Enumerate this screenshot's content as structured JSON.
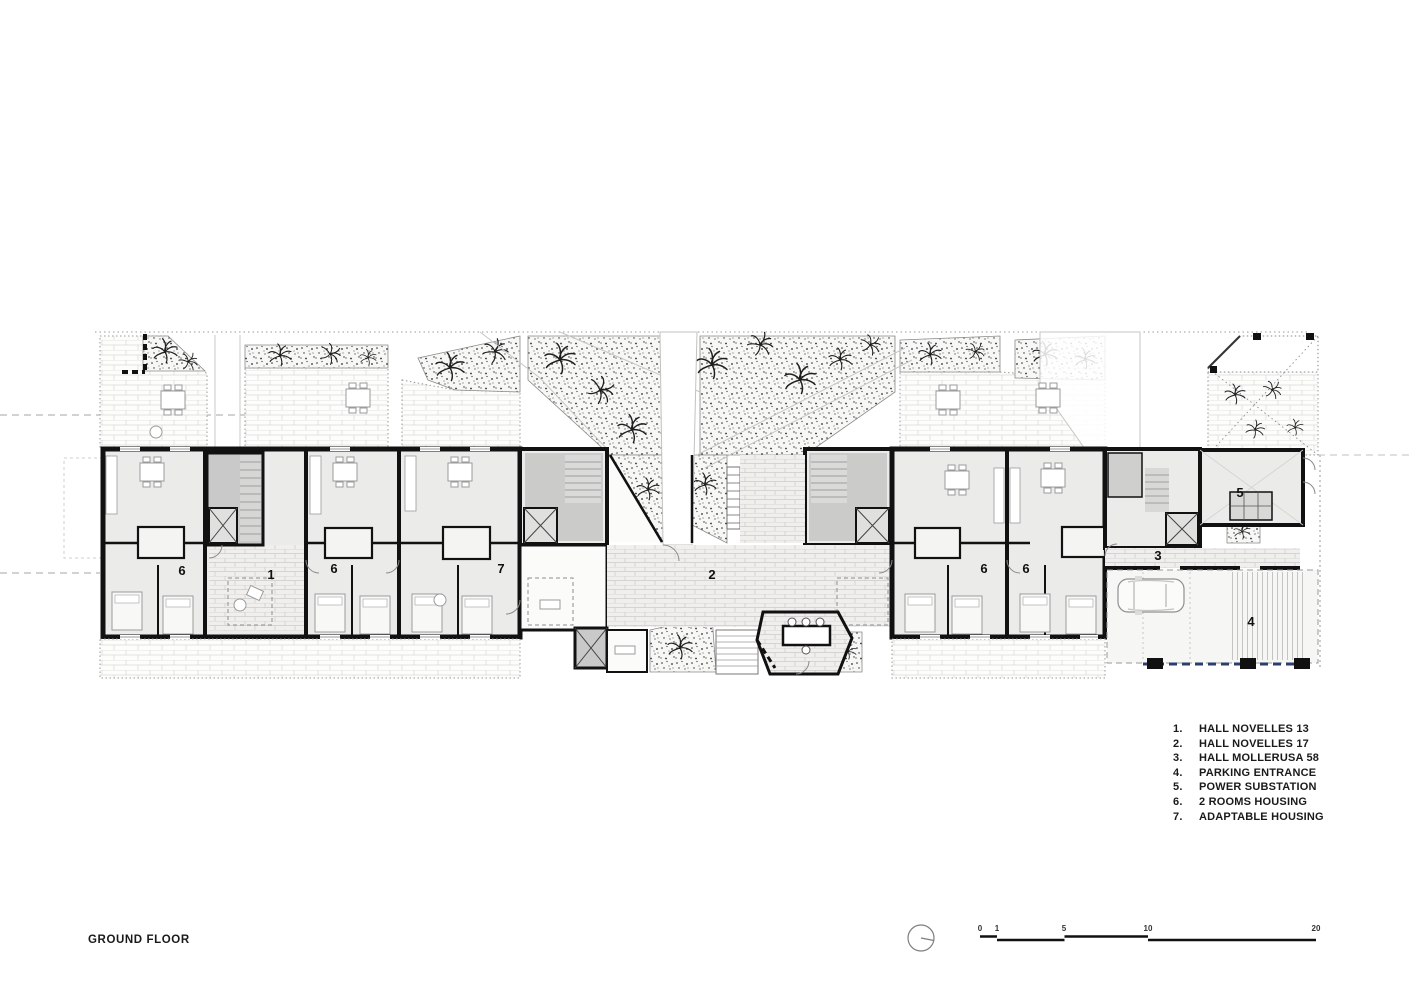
{
  "page": {
    "title": "GROUND FLOOR"
  },
  "legend": {
    "items": [
      {
        "num": "1.",
        "label": "HALL NOVELLES 13"
      },
      {
        "num": "2.",
        "label": "HALL NOVELLES 17"
      },
      {
        "num": "3.",
        "label": "HALL MOLLERUSA 58"
      },
      {
        "num": "4.",
        "label": "PARKING ENTRANCE"
      },
      {
        "num": "5.",
        "label": "POWER SUBSTATION"
      },
      {
        "num": "6.",
        "label": "2 ROOMS HOUSING"
      },
      {
        "num": "7.",
        "label": "ADAPTABLE HOUSING"
      }
    ]
  },
  "plan": {
    "labels": [
      {
        "text": "6"
      },
      {
        "text": "1"
      },
      {
        "text": "6"
      },
      {
        "text": "7"
      },
      {
        "text": "2"
      },
      {
        "text": "6"
      },
      {
        "text": "6"
      },
      {
        "text": "3"
      },
      {
        "text": "5"
      },
      {
        "text": "4"
      }
    ]
  },
  "scale_bar": {
    "ticks": [
      "0",
      "1",
      "5",
      "10",
      "20"
    ]
  },
  "icons": {
    "north": "north-arrow-icon"
  },
  "colors": {
    "ink": "#111111",
    "room_fill": "#ebebea",
    "core_fill": "#c9c9c9",
    "hall_fill": "#f0efed",
    "terrace_line": "#d6d6d6",
    "vegetation_ink": "#222222",
    "parking_dash_blue": "#2c3e6b"
  }
}
